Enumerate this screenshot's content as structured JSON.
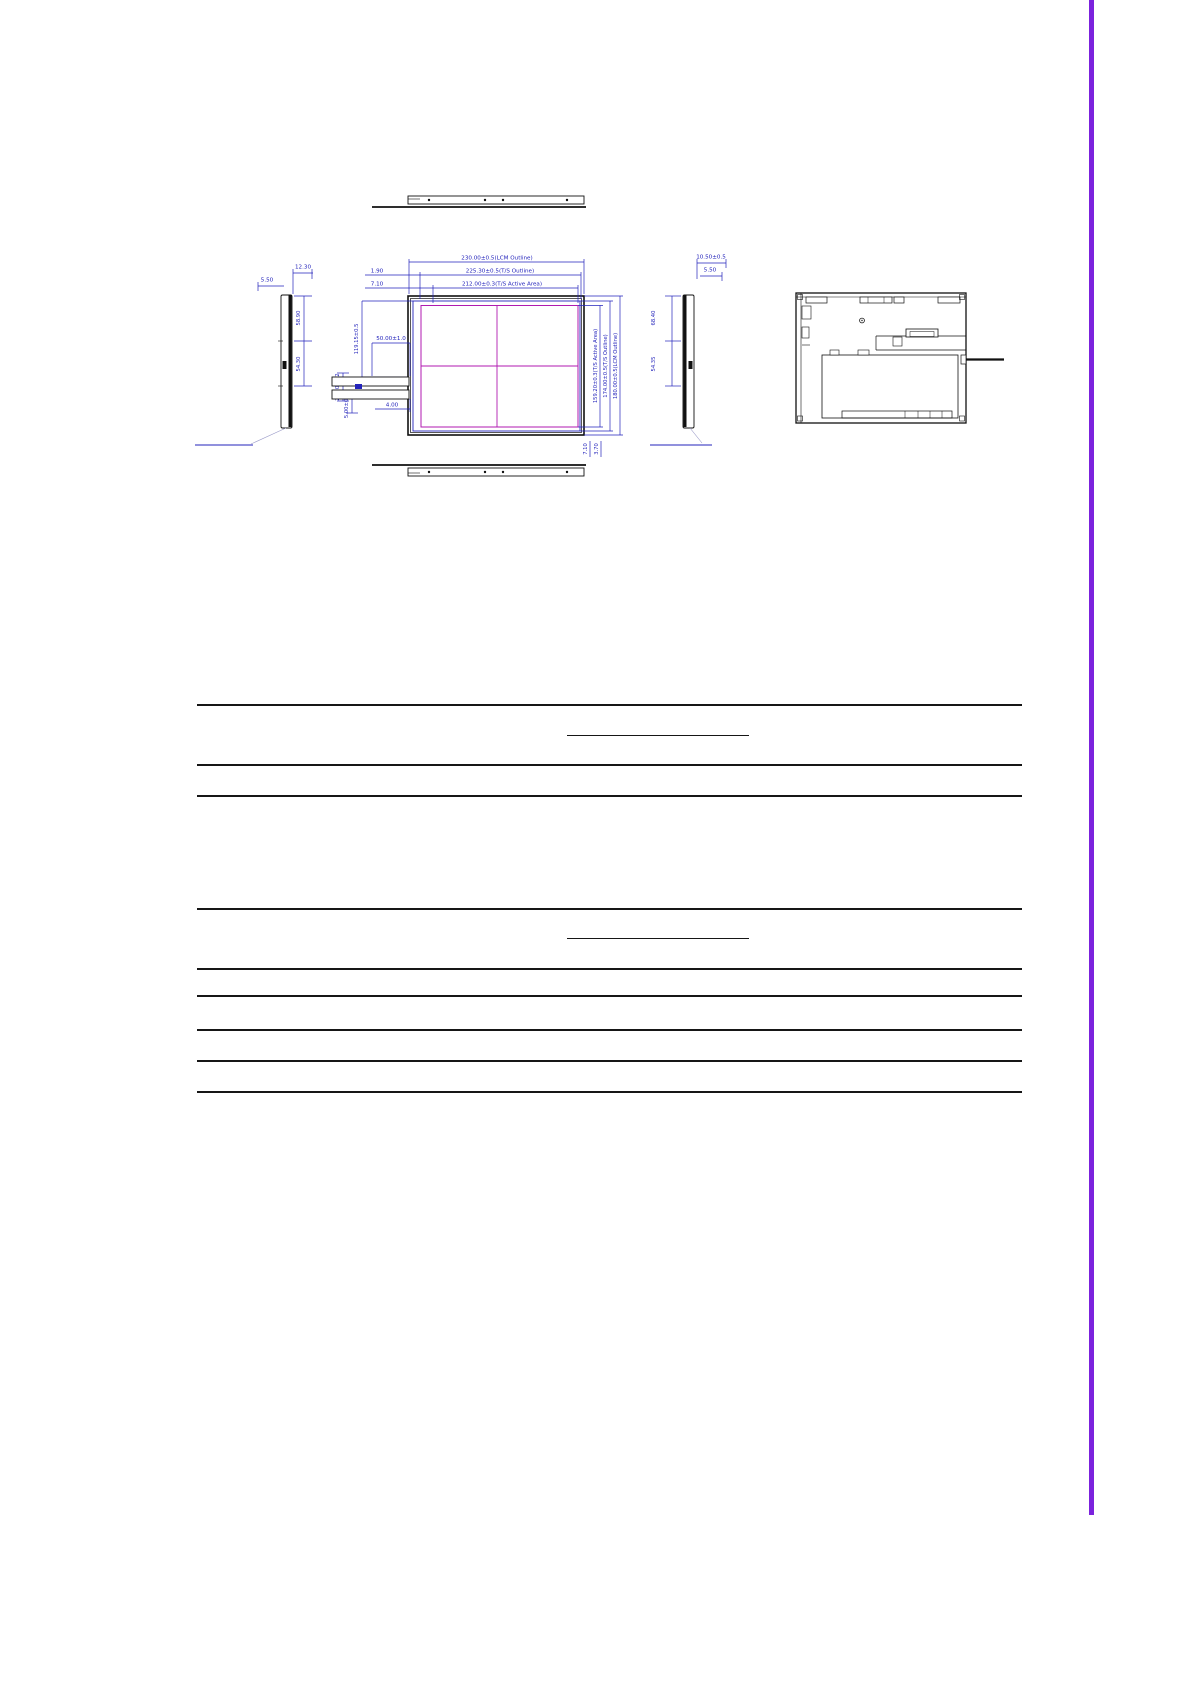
{
  "accent": {
    "bar_color": "#7b22dd"
  },
  "drawing": {
    "colors": {
      "dimension_blue": "#2323bb",
      "active_magenta": "#b01ab0",
      "outline_black": "#111111"
    },
    "front_view": {
      "width_lcm": "230.00±0.5(LCM Outline)",
      "width_ts": "225.30±0.5(T/S Outline)",
      "width_active": "212.00±0.3(T/S Active Area)",
      "edge_gap_ts": "1.90",
      "edge_gap_active": "7.10",
      "height_active": "159.20±0.3(T/S Active Area)",
      "height_ts": "174.00±0.5(T/S Outline)",
      "height_lcm": "180.00±0.5(LCM Outline)",
      "fpc_center_offset": "119.15±0.5",
      "fpc_width": "50.00±1.0",
      "fpc_tail_width": "22.00±0.2",
      "fpc_tail_height": "5.00±0.2",
      "fpc_edge_offset": "4.00",
      "bottom_gap_ts": "7.10",
      "bottom_gap_active": "3.70"
    },
    "left_side_view": {
      "thickness_total": "12.30",
      "thickness_front": "5.50",
      "upper_span": "58.90",
      "lower_span": "54.30"
    },
    "right_side_view": {
      "thickness_total": "10.50±0.5",
      "thickness_front": "5.50",
      "upper_span": "68.40",
      "lower_span": "54.35"
    }
  }
}
